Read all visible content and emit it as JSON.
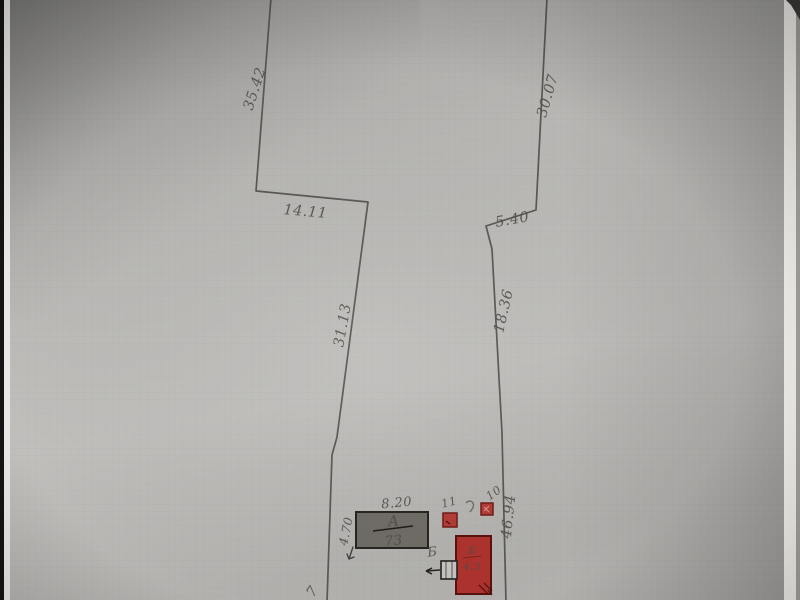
{
  "colors": {
    "paper": "#b7b6b3",
    "pencil": "#524f4b",
    "building_red": "#ad332d",
    "shed_red": "#b23c36",
    "building_gray": "#6f6b65"
  },
  "plan": {
    "dims": {
      "left_upper": "35.42",
      "top_jog": "14.11",
      "left_middle": "31.13",
      "right_upper": "30.07",
      "right_jog": "5.40",
      "right_middle": "18.36",
      "right_lower": "46.94"
    },
    "buildings": {
      "main": {
        "width": "8.20",
        "depth": "4.70",
        "letter": "А",
        "number": "73"
      },
      "shed_left": {
        "label": "11"
      },
      "shed_right": {
        "label": "10"
      },
      "barn": {
        "label": "Б",
        "inner_letter": "Б",
        "inner_number": "4.3"
      },
      "edge_partial": "7"
    }
  }
}
